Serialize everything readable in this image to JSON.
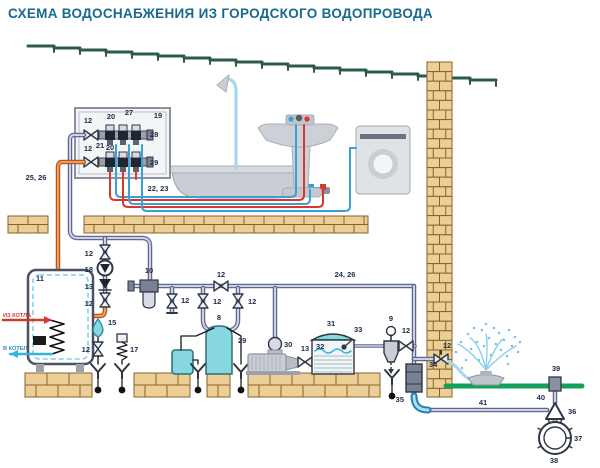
{
  "title": "СХЕМА ВОДОСНАБЖЕНИЯ ИЗ ГОРОДСКОГО ВОДОПРОВОДА",
  "colors": {
    "title": "#17698e",
    "label": "#1c2b4a",
    "hot_edge": "#b5581c",
    "hot_inner": "#f09a5c",
    "cold_edge": "#63688a",
    "cold_inner": "#cdd1e8",
    "blue_line": "#3d9fd4",
    "red_line": "#d6392b",
    "light_blue": "#a5d8ef",
    "cyan_fill": "#86d8de",
    "brick": "#eccf96",
    "brick_edge": "#8a6228",
    "roof": "#2a5c46",
    "ground_green": "#12a05a",
    "metal": "#c9ced5",
    "dark": "#2f3744"
  },
  "labels": [
    {
      "t": "12",
      "x": 88,
      "y": 123,
      "n": "valve-manifold-cold"
    },
    {
      "t": "20",
      "x": 111,
      "y": 119,
      "n": "manifold-cold-outlet"
    },
    {
      "t": "27",
      "x": 129,
      "y": 115,
      "n": "manifold-cold"
    },
    {
      "t": "21",
      "x": 100,
      "y": 148,
      "n": "manifold-fitting"
    },
    {
      "t": "28",
      "x": 150,
      "y": 137,
      "a": "start",
      "n": "manifold-cold-end"
    },
    {
      "t": "12",
      "x": 88,
      "y": 151,
      "n": "valve-manifold-hot"
    },
    {
      "t": "20",
      "x": 110,
      "y": 150,
      "n": "manifold-hot-outlet"
    },
    {
      "t": "29",
      "x": 150,
      "y": 165,
      "a": "start",
      "n": "manifold-hot-end"
    },
    {
      "t": "19",
      "x": 158,
      "y": 118,
      "n": "manifold-cabinet"
    },
    {
      "t": "25, 26",
      "x": 36,
      "y": 180,
      "n": "boiler-riser-pipes"
    },
    {
      "t": "22, 23",
      "x": 158,
      "y": 191,
      "n": "fixture-supply-lines"
    },
    {
      "t": "11",
      "x": 36,
      "y": 281,
      "a": "start",
      "n": "storage-boiler"
    },
    {
      "t": "ИЗ КОТЛА",
      "x": 3,
      "y": 317,
      "a": "start",
      "c": "red small",
      "n": "from-heating-boiler"
    },
    {
      "t": "В КОТЕЛ",
      "x": 3,
      "y": 350,
      "a": "start",
      "c": "blue small",
      "n": "to-heating-boiler"
    },
    {
      "t": "12",
      "x": 93,
      "y": 256,
      "a": "end",
      "n": "valve-column-top"
    },
    {
      "t": "18",
      "x": 93,
      "y": 272,
      "a": "end",
      "n": "circulation-pump"
    },
    {
      "t": "13",
      "x": 93,
      "y": 289,
      "a": "end",
      "n": "check-valve-column"
    },
    {
      "t": "12",
      "x": 93,
      "y": 306,
      "a": "end",
      "n": "valve-column-bottom"
    },
    {
      "t": "15",
      "x": 108,
      "y": 325,
      "a": "start",
      "n": "expansion-tank"
    },
    {
      "t": "12",
      "x": 90,
      "y": 352,
      "a": "end",
      "n": "boiler-drain-valve"
    },
    {
      "t": "17",
      "x": 130,
      "y": 352,
      "a": "start",
      "n": "safety-valve"
    },
    {
      "t": "10",
      "x": 149,
      "y": 273,
      "n": "main-filter"
    },
    {
      "t": "12",
      "x": 181,
      "y": 303,
      "a": "start",
      "n": "drain-tap-main"
    },
    {
      "t": "12",
      "x": 221,
      "y": 277,
      "n": "valve-main-line"
    },
    {
      "t": "12",
      "x": 213,
      "y": 304,
      "a": "start",
      "n": "valve-softener-left"
    },
    {
      "t": "12",
      "x": 248,
      "y": 304,
      "a": "start",
      "n": "valve-softener-right"
    },
    {
      "t": "8",
      "x": 219,
      "y": 320,
      "n": "water-softener"
    },
    {
      "t": "24, 26",
      "x": 345,
      "y": 277,
      "n": "main-supply-line"
    },
    {
      "t": "30",
      "x": 284,
      "y": 347,
      "a": "start",
      "n": "pump-fitting"
    },
    {
      "t": "29",
      "x": 238,
      "y": 343,
      "a": "start",
      "n": "pump-station-pump"
    },
    {
      "t": "13",
      "x": 305,
      "y": 351,
      "n": "check-valve-pump"
    },
    {
      "t": "31",
      "x": 331,
      "y": 326,
      "n": "accumulator-tank"
    },
    {
      "t": "32",
      "x": 316,
      "y": 349,
      "a": "start",
      "n": "tank-water"
    },
    {
      "t": "33",
      "x": 354,
      "y": 332,
      "a": "start",
      "n": "float-valve"
    },
    {
      "t": "9",
      "x": 391,
      "y": 321,
      "n": "fine-filter"
    },
    {
      "t": "12",
      "x": 406,
      "y": 333,
      "n": "valve-after-filter"
    },
    {
      "t": "34",
      "x": 429,
      "y": 367,
      "a": "start",
      "n": "foundation-sleeve"
    },
    {
      "t": "12",
      "x": 447,
      "y": 348,
      "n": "garden-tap"
    },
    {
      "t": "35",
      "x": 404,
      "y": 402,
      "a": "end",
      "n": "outdoor-elbow"
    },
    {
      "t": "41",
      "x": 483,
      "y": 405,
      "n": "buried-supply-pipe"
    },
    {
      "t": "39",
      "x": 556,
      "y": 371,
      "n": "well-head"
    },
    {
      "t": "40",
      "x": 545,
      "y": 400,
      "a": "end",
      "n": "well-riser"
    },
    {
      "t": "36",
      "x": 568,
      "y": 414,
      "a": "start",
      "n": "check-valve-well"
    },
    {
      "t": "37",
      "x": 574,
      "y": 441,
      "a": "start",
      "n": "well-casing"
    },
    {
      "t": "38",
      "x": 554,
      "y": 463,
      "n": "well"
    }
  ]
}
